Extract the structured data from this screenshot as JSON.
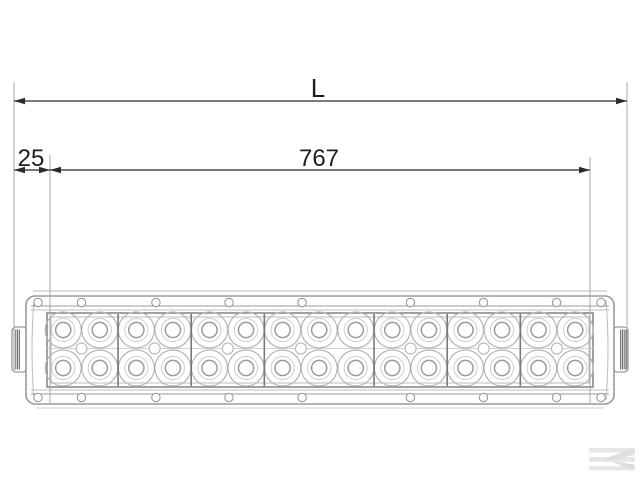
{
  "drawing": {
    "kind": "dimensioned front view of a double-row LED light bar",
    "led_rows": 2,
    "led_columns": 15,
    "lens_segments": 7
  },
  "dimensions": {
    "overall": {
      "label": "L"
    },
    "offset": {
      "value": "25"
    },
    "span": {
      "value": "767"
    }
  },
  "colors": {
    "background": "#ffffff",
    "dimension_line": "#2b2b2b",
    "extension_line": "#a9a9a9",
    "outline_dark": "#787878",
    "outline_mid": "#9a9a9a",
    "outline_light": "#bcbcbc",
    "outline_xlight": "#d2d2d2",
    "led_outer": "#b5b5b5",
    "led_mid": "#cdcdcd",
    "led_inner": "#9a9a9a",
    "watermark": "#e6e6e6"
  },
  "watermark": {
    "name": "kramp-logo"
  }
}
